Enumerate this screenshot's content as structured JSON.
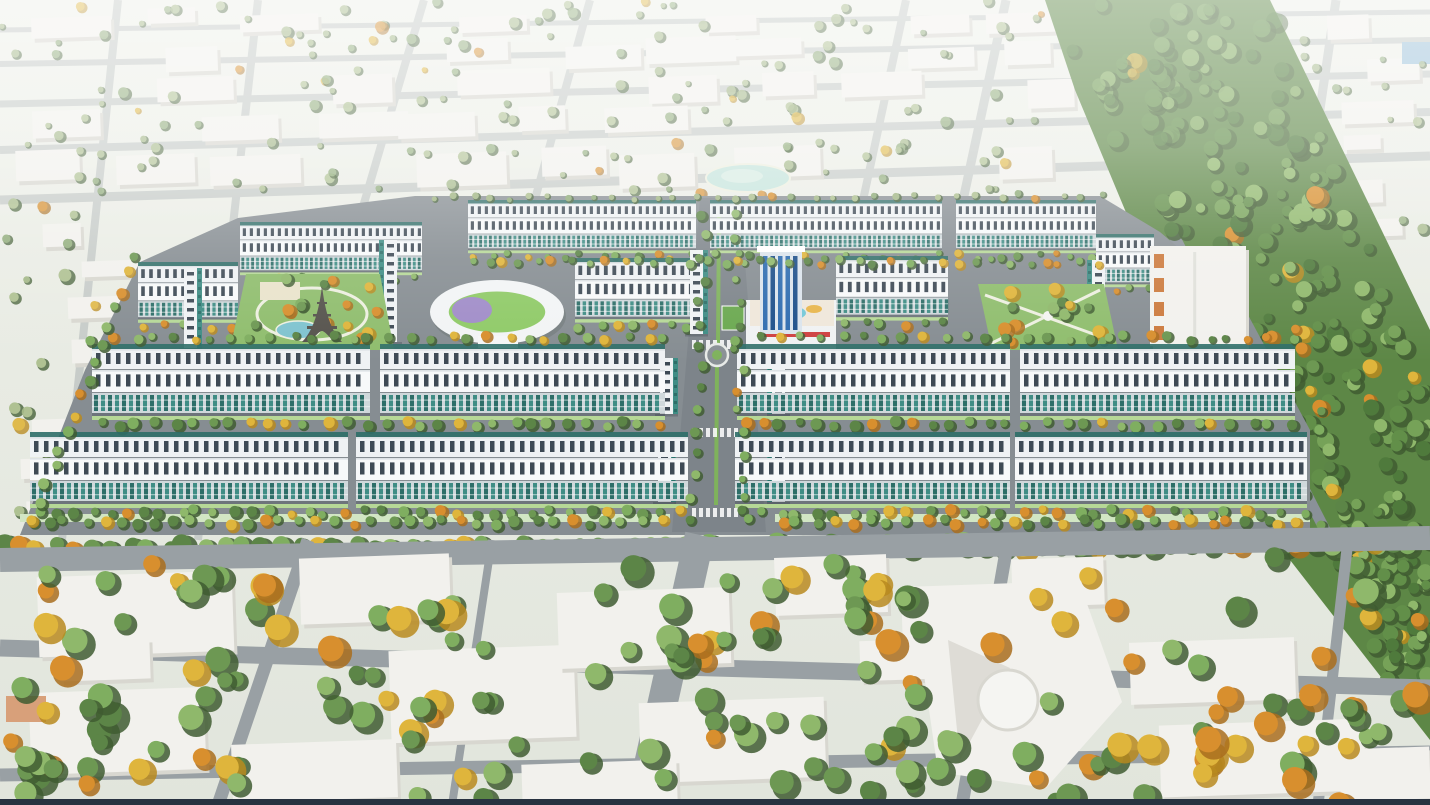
{
  "scene": {
    "type": "aerial-3d-masterplan-render",
    "description": "Bird's-eye perspective rendering of a new urban residential development of long teal-and-white shophouse rows set within a hazy pale existing city, with two landscaped parks (one containing an Eiffel-tower replica and pond), an oval school building, a blue high-rise plaza tower, a central tree-lined boulevard with a roundabout, a broad diagonal forest corridor on the right, and large low-detail white city blocks with dense green and yellow trees in the foreground.",
    "visible_text": [],
    "landmarks": [
      "shophouse-rows",
      "eiffel-tower-replica",
      "left-park-pond",
      "kindergarten-oval-building",
      "central-plaza-tower",
      "rooftop-pool-deck",
      "right-park",
      "central-boulevard-roundabout",
      "forest-corridor",
      "campus-pond",
      "orange-accent-building",
      "foreground-civic-building"
    ]
  },
  "palette": {
    "ground_top": "#eef0e9",
    "ground_bottom": "#e1e5dc",
    "bg_road": "#c7ccc9",
    "fg_road": "#99a0a4",
    "dev_road": "#868d92",
    "edge_road": "#8a9199",
    "block_fill": "#f2f1ed",
    "block_shade": "#d8d7d0",
    "roof_white": "#eff2f4",
    "roof_bright": "#f7f9fa",
    "roof_lip": "#dde2e5",
    "roof_win": "#3e4a55",
    "facade_base": "#cfd8db",
    "facade_glass": "#3f8d85",
    "facade_glass_dark": "#2d6e68",
    "verge": "#b6d897",
    "mint_walk": "#d2e6c4",
    "lawn": "#8fbd6d",
    "water": "#7fc3cf",
    "pond_pale": "#c5e4dc",
    "tree_greens": [
      "#6d9853",
      "#7fae60",
      "#5c8547",
      "#8fb86b"
    ],
    "tree_pale_greens": [
      "#9db37f",
      "#8aa873",
      "#a9bd8a"
    ],
    "forest_greens": [
      "#628f49",
      "#76a258",
      "#4f7a3c",
      "#8fb86b"
    ],
    "forest_base": "#5d8746",
    "tree_yellow": "#dfb53c",
    "tree_yellow_dark": "#b8891f",
    "tree_orange": "#d88f2e",
    "tree_orange_dark": "#a96d1d",
    "tower_blue": "#2e6cb0",
    "tower_blue_dark": "#1c4f8a",
    "tower_frame": "#dbe4ec",
    "podium_white": "#f0f2f3",
    "deck_base": "#efe7da",
    "deck_pool": "#74c8d8",
    "deck_accent": "#e8b64c",
    "sign_red": "#cf4040",
    "court_green": "#6aa84f",
    "school_ring": "#f2f4f5",
    "school_green": "#8fca67",
    "school_purple": "#a08cc8",
    "eiffel_iron": "#55524c",
    "orange_accent": "#cc7a3d",
    "path_white": "#edefe0",
    "median_green": "#7fb25c",
    "haze": "#ffffff",
    "bottom_bar": "#283240",
    "far_blue_patch": "#9fc3da",
    "fg_orange_roof": "#d8a07a"
  },
  "layout": {
    "canvas": {
      "w": 1430,
      "h": 805
    },
    "seed": 42,
    "bg_roads_h": [
      [
        0,
        30,
        1430,
        12,
        5
      ],
      [
        0,
        64,
        1430,
        40,
        6
      ],
      [
        0,
        104,
        1430,
        74,
        7
      ],
      [
        0,
        150,
        1430,
        112,
        8
      ],
      [
        0,
        200,
        1430,
        156,
        9
      ]
    ],
    "bg_roads_v": [
      [
        118,
        0,
        62,
        540,
        8
      ],
      [
        258,
        0,
        198,
        540,
        8
      ],
      [
        424,
        0,
        362,
        210,
        8
      ],
      [
        590,
        0,
        532,
        210,
        8
      ],
      [
        906,
        0,
        862,
        205,
        8
      ],
      [
        1006,
        0,
        962,
        205,
        9
      ],
      [
        1336,
        0,
        1292,
        300,
        9
      ]
    ],
    "bg_block_rows": [
      6,
      36,
      68,
      104,
      146
    ],
    "campus_pond": {
      "cx": 748,
      "cy": 178,
      "rx": 42,
      "ry": 14
    },
    "far_blue_patch": {
      "x": 1402,
      "y": 42,
      "w": 28,
      "h": 22
    },
    "forest": {
      "outline": [
        [
          1045,
          0
        ],
        [
          1270,
          0
        ],
        [
          1430,
          330
        ],
        [
          1430,
          740
        ],
        [
          1290,
          560
        ],
        [
          1175,
          330
        ],
        [
          1075,
          90
        ]
      ],
      "left_edge_base": 1045,
      "left_edge_slope": 0.5,
      "right_edge_base": 1270,
      "right_edge_slope": 0.4,
      "count": 260,
      "y_max": 680
    },
    "edge_road": {
      "x1": 1170,
      "y1": 228,
      "x2": 1326,
      "y2": 532,
      "w": 11
    },
    "dev": {
      "outline": [
        [
          415,
          196
        ],
        [
          1100,
          196
        ],
        [
          1160,
          232
        ],
        [
          1240,
          300
        ],
        [
          1310,
          430
        ],
        [
          1310,
          535
        ],
        [
          20,
          535
        ],
        [
          85,
          370
        ],
        [
          140,
          262
        ],
        [
          238,
          218
        ]
      ],
      "boulevard": {
        "poly": [
          [
            700,
            198
          ],
          [
            740,
            198
          ],
          [
            766,
            532
          ],
          [
            672,
            532
          ]
        ],
        "median": [
          [
            719,
            212,
            718,
            345
          ],
          [
            717,
            366,
            716,
            505
          ]
        ],
        "roundabout": {
          "cx": 717,
          "cy": 355,
          "r": 11,
          "inner": 5
        },
        "crosswalk_y": [
          340,
          428,
          508
        ]
      },
      "sidewalks": [
        [
          20,
          514,
          650,
          8
        ],
        [
          775,
          514,
          535,
          8
        ]
      ],
      "top_rows": [
        [
          468,
          200,
          228,
          0.7
        ],
        [
          710,
          200,
          232,
          0.7
        ],
        [
          956,
          200,
          140,
          0.7
        ],
        [
          240,
          222,
          182,
          0.7
        ],
        [
          1096,
          234,
          58,
          0.7
        ]
      ],
      "mid_rows": [
        [
          575,
          258,
          118,
          0.85
        ],
        [
          836,
          256,
          112,
          0.85
        ],
        [
          138,
          262,
          100,
          0.8
        ]
      ],
      "band_m": [
        [
          92,
          344,
          278,
          1
        ],
        [
          380,
          344,
          285,
          1
        ],
        [
          737,
          344,
          273,
          1
        ],
        [
          1020,
          344,
          275,
          1
        ]
      ],
      "band_f": [
        [
          30,
          432,
          318,
          1
        ],
        [
          356,
          432,
          332,
          1
        ],
        [
          735,
          432,
          275,
          1
        ],
        [
          1015,
          432,
          292,
          1
        ]
      ],
      "v_rows": [
        [
          690,
          250,
          84,
          "right"
        ],
        [
          772,
          358,
          56,
          "left"
        ],
        [
          660,
          358,
          56,
          "right"
        ],
        [
          772,
          444,
          58,
          "left"
        ],
        [
          658,
          444,
          58,
          "right"
        ],
        [
          184,
          268,
          80,
          "right"
        ],
        [
          384,
          240,
          102,
          "left"
        ],
        [
          1092,
          260,
          88,
          "left"
        ]
      ],
      "orange_building": {
        "x": 1150,
        "y": 246,
        "w": 96,
        "h": 100
      },
      "school": {
        "cx": 497,
        "cy": 312,
        "rx": 67,
        "ry": 32
      },
      "left_park": {
        "poly": [
          [
            246,
            274
          ],
          [
            380,
            274
          ],
          [
            394,
            350
          ],
          [
            230,
            350
          ]
        ],
        "pond": {
          "cx": 298,
          "cy": 330,
          "rx": 22,
          "ry": 9
        },
        "ring": {
          "cx": 312,
          "cy": 314,
          "rx": 55,
          "ry": 26
        },
        "plaza": [
          260,
          282,
          40,
          18
        ],
        "eiffel": {
          "apex_x": 322,
          "apex_y": 286,
          "base_y": 342,
          "half": 20
        }
      },
      "right_park": {
        "poly": [
          [
            978,
            284
          ],
          [
            1104,
            284
          ],
          [
            1118,
            350
          ],
          [
            992,
            350
          ]
        ],
        "gazebo": {
          "cx": 1048,
          "cy": 316,
          "r": 5
        }
      },
      "tower": {
        "shaft": [
          760,
          250,
          42,
          84
        ],
        "cap": [
          757,
          246,
          48,
          6
        ],
        "podium": [
          746,
          300,
          90,
          50
        ],
        "deck": [
          750,
          300,
          84,
          26
        ],
        "sign": [
          758,
          332,
          72,
          5
        ],
        "court": [
          722,
          306,
          22,
          24
        ]
      }
    },
    "fg_roads": [
      [
        0,
        560,
        1430,
        538,
        24
      ],
      [
        0,
        648,
        1430,
        688,
        17
      ],
      [
        0,
        775,
        1430,
        752,
        13
      ],
      [
        308,
        540,
        218,
        805,
        13
      ],
      [
        700,
        535,
        640,
        805,
        30
      ],
      [
        1008,
        540,
        962,
        805,
        13
      ],
      [
        1348,
        540,
        1318,
        805,
        11
      ],
      [
        492,
        540,
        452,
        805,
        8
      ]
    ],
    "fg_blocks": [
      [
        38,
        574,
        195,
        80
      ],
      [
        300,
        556,
        150,
        66
      ],
      [
        390,
        648,
        185,
        92
      ],
      [
        30,
        690,
        175,
        82
      ],
      [
        558,
        590,
        172,
        76
      ],
      [
        640,
        700,
        185,
        80
      ],
      [
        775,
        556,
        112,
        58
      ],
      [
        902,
        585,
        120,
        66
      ],
      [
        1130,
        640,
        165,
        62
      ],
      [
        1160,
        722,
        205,
        72
      ],
      [
        232,
        742,
        165,
        58
      ],
      [
        522,
        762,
        155,
        42
      ],
      [
        1012,
        558,
        92,
        48
      ],
      [
        1340,
        748,
        90,
        52
      ],
      [
        60,
        640,
        90,
        40
      ],
      [
        860,
        640,
        70,
        40
      ]
    ],
    "fg_orange_roof": [
      6,
      696,
      40,
      26
    ],
    "civic": {
      "body": "M915,612 L1085,598 L1122,702 L1046,788 L938,772 Z",
      "circle": {
        "cx": 1008,
        "cy": 700,
        "r": 30
      },
      "wedge": "M948,640 L1010,668 L960,760 Z"
    },
    "tree_lines": [
      {
        "x1": 470,
        "y1": 262,
        "x2": 1095,
        "y2": 262,
        "n": 38,
        "r0": 3.5,
        "r1": 5.5,
        "yc": 0.25
      },
      {
        "x1": 95,
        "y1": 338,
        "x2": 665,
        "y2": 338,
        "n": 30,
        "r0": 4,
        "r1": 6,
        "yc": 0.3
      },
      {
        "x1": 740,
        "y1": 338,
        "x2": 1290,
        "y2": 338,
        "n": 28,
        "r0": 4,
        "r1": 6,
        "yc": 0.3
      },
      {
        "x1": 705,
        "y1": 215,
        "x2": 694,
        "y2": 520,
        "n": 15,
        "r0": 4,
        "r1": 6,
        "yc": 0.1
      },
      {
        "x1": 734,
        "y1": 215,
        "x2": 744,
        "y2": 520,
        "n": 15,
        "r0": 4,
        "r1": 6,
        "yc": 0.1
      },
      {
        "x1": 135,
        "y1": 255,
        "x2": 35,
        "y2": 520,
        "n": 16,
        "r0": 5,
        "r1": 7,
        "yc": 0.3
      },
      {
        "x1": 1300,
        "y1": 330,
        "x2": 1345,
        "y2": 528,
        "n": 11,
        "r0": 5,
        "r1": 8,
        "yc": 0.45
      },
      {
        "x1": 30,
        "y1": 522,
        "x2": 660,
        "y2": 522,
        "n": 36,
        "r0": 5,
        "r1": 7,
        "yc": 0.3
      },
      {
        "x1": 780,
        "y1": 522,
        "x2": 1300,
        "y2": 522,
        "n": 30,
        "r0": 5,
        "r1": 7,
        "yc": 0.3
      },
      {
        "x1": 0,
        "y1": 547,
        "x2": 1430,
        "y2": 543,
        "n": 78,
        "r0": 8,
        "r1": 13,
        "yc": 0.22
      }
    ],
    "tree_patches": [
      {
        "x": 30,
        "y": 560,
        "w": 250,
        "h": 130,
        "n": 20,
        "yc": 0.3
      },
      {
        "x": 300,
        "y": 585,
        "w": 220,
        "h": 150,
        "n": 16,
        "yc": 0.25
      },
      {
        "x": 545,
        "y": 565,
        "w": 190,
        "h": 110,
        "n": 14,
        "yc": 0.3
      },
      {
        "x": 740,
        "y": 560,
        "w": 180,
        "h": 80,
        "n": 12,
        "yc": 0.45
      },
      {
        "x": 835,
        "y": 585,
        "w": 230,
        "h": 170,
        "n": 18,
        "yc": 0.3
      },
      {
        "x": 1080,
        "y": 550,
        "w": 330,
        "h": 240,
        "n": 26,
        "yc": 0.3
      },
      {
        "x": 0,
        "y": 670,
        "w": 280,
        "h": 130,
        "n": 16,
        "yc": 0.2
      },
      {
        "x": 380,
        "y": 690,
        "w": 330,
        "h": 115,
        "n": 14,
        "yc": 0.25
      },
      {
        "x": 640,
        "y": 720,
        "w": 260,
        "h": 85,
        "n": 12,
        "yc": 0.3
      },
      {
        "x": 900,
        "y": 740,
        "w": 260,
        "h": 65,
        "n": 10,
        "yc": 0.25
      },
      {
        "x": 1140,
        "y": 690,
        "w": 290,
        "h": 115,
        "n": 16,
        "yc": 0.5
      },
      {
        "x": 20,
        "y": 745,
        "w": 250,
        "h": 60,
        "n": 10,
        "yc": 0.35
      }
    ],
    "bg_scatter": {
      "n_top": 160,
      "x_max": 1045,
      "y_max": 195,
      "n_right": 18,
      "n_left": 22
    },
    "haze_stops": [
      [
        0,
        0.55
      ],
      [
        0.18,
        0.38
      ],
      [
        0.32,
        0.12
      ],
      [
        0.45,
        0
      ]
    ],
    "bottom_bar_h": 6
  }
}
